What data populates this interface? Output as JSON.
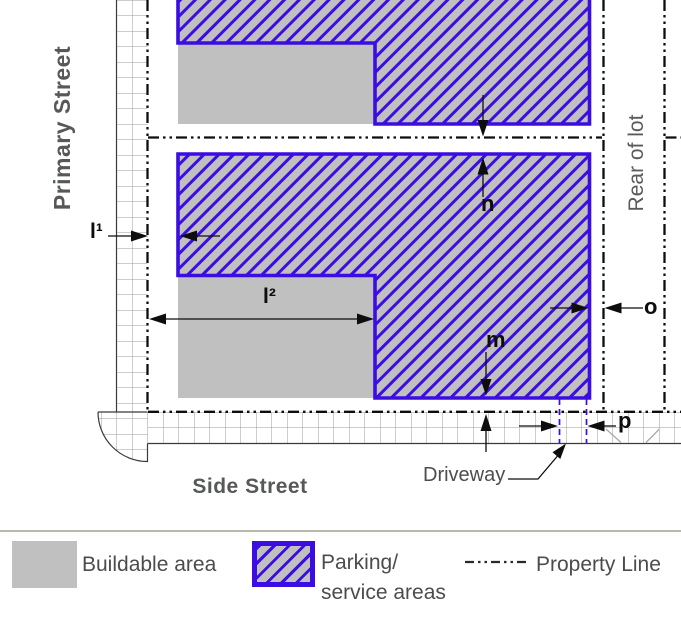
{
  "labels": {
    "primary_street": "Primary Street",
    "side_street": "Side Street",
    "rear_of_lot": "Rear of lot",
    "driveway": "Driveway"
  },
  "dimensions": {
    "l1": "l¹",
    "l2": "l²",
    "m": "m",
    "n": "n",
    "o": "o",
    "p": "p"
  },
  "legend": {
    "buildable_label": "Buildable area",
    "parking_label_line1": "Parking/",
    "parking_label_line2": "service areas",
    "property_line_label": "Property Line"
  },
  "colors": {
    "parking_border_blue": "#3b0de2",
    "area_gray": "#c0c0c0",
    "street_grid_gray": "#9b9b9b",
    "property_line_black": "#0d0d0d",
    "street_label_gray": "#57585a"
  }
}
